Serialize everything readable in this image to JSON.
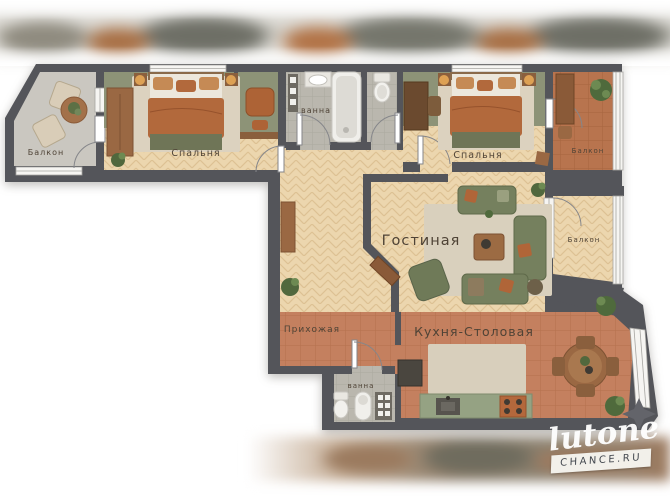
{
  "rooms": {
    "balcony_left": {
      "label": "Балкон"
    },
    "bedroom_left": {
      "label": "Спальня"
    },
    "bathroom_top": {
      "label": "ванна"
    },
    "bedroom_right": {
      "label": "Спальня"
    },
    "balcony_top_right": {
      "label": "Балкон"
    },
    "living_room": {
      "label": "Гостиная"
    },
    "balcony_right": {
      "label": "Балкон"
    },
    "hallway": {
      "label": "Прихожая"
    },
    "kitchen_dining": {
      "label": "Кухня-Столовая"
    },
    "bathroom_bottom": {
      "label": "ванна"
    }
  },
  "watermark": {
    "logo": "lutone",
    "site": "CHANCE.RU"
  },
  "colors": {
    "wall": "#54555a",
    "wood_floor": "#ecd6ae",
    "terracotta_floor": "#c4805f",
    "balcony_terracotta": "#b8744e",
    "tile_floor": "#bab7ae",
    "concrete_floor": "#cac7c0",
    "green_wall": "#8d9377",
    "sofa_green": "#75805e",
    "accent_orange": "#b2693c",
    "furniture_wood": "#9a6843",
    "rug_beige": "#dcd2bf",
    "kitchen_counter": "#95a283"
  }
}
